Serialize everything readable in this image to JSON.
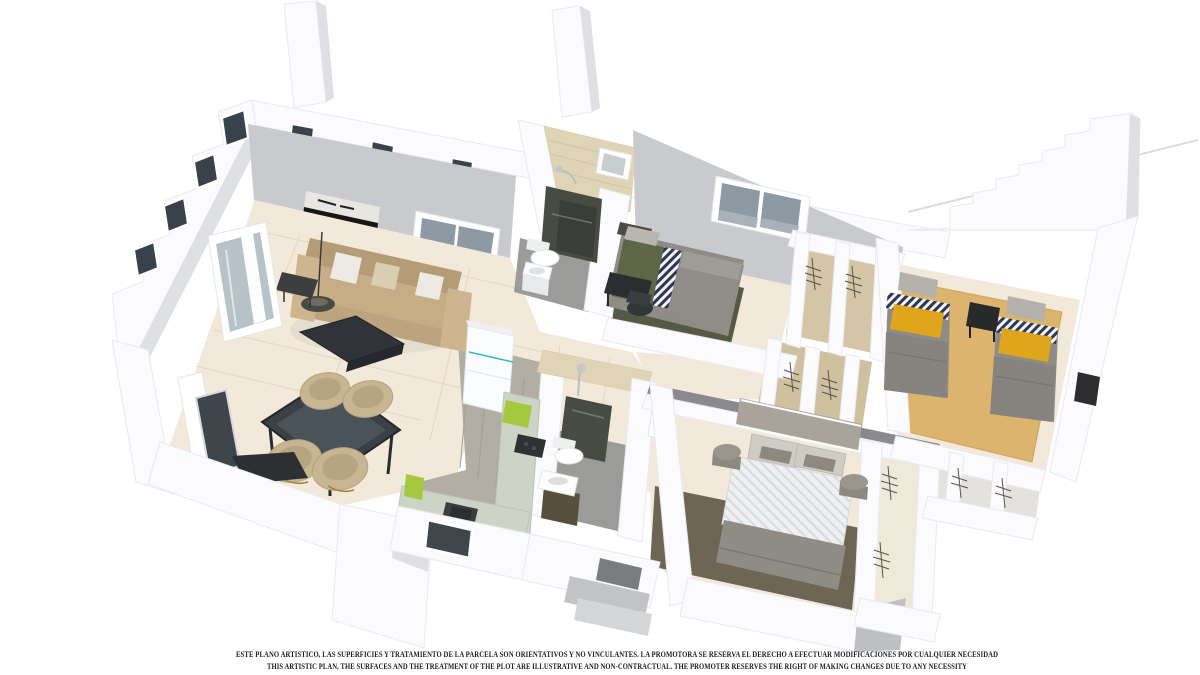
{
  "image_type": "3d-floor-plan-render",
  "disclaimer": {
    "line_es": "ESTE PLANO ARTISTICO, LAS SUPERFICIES Y TRATAMIENTO DE LA PARCELA SON ORIENTATIVOS Y NO VINCULANTES. LA PROMOTORA SE RESERVA EL DERECHO A EFECTUAR MODIFICACIONES POR CUALQUIER NECESIDAD",
    "line_en": "THIS ARTISTIC PLAN, THE SURFACES AND THE TREATMENT OF THE PLOT ARE ILLUSTRATIVE AND NON-CONTRACTUAL. THE PROMOTER RESERVES THE RIGHT OF MAKING CHANGES DUE TO ANY NECESSITY"
  },
  "colors": {
    "background": "#ffffff",
    "exterior_wall": "#fbfbfd",
    "interior_wall_gray": "#c9cacd",
    "bathroom_wall_beige": "#e0d4b6",
    "tile_floor_beige": "#f2e9da",
    "kitchen_wood_gray": "#b2aea4",
    "bathroom_floor_gray": "#9b9b99",
    "shower_panel_dark": "#474b44",
    "twin_carpet_tan": "#dcb46e",
    "rug_olive": "#545a44",
    "rug_master_brown": "#6e6555",
    "sofa_tan": "#c6ad86",
    "mustard_blanket": "#dfa61d",
    "chevron_pillow_navy": "#2e3756",
    "lime_cabinet_accent": "#a4c93e",
    "fridge_accent_teal": "#37b6c9",
    "furniture_black": "#2d3033"
  },
  "rooms": [
    {
      "id": "living-dining",
      "floor": "beige tile",
      "furniture": [
        "tan-sofa",
        "white-cushions",
        "wall-art",
        "floor-lamp",
        "side-table",
        "coffee-table",
        "glass-dining-table",
        "four-tub-chairs",
        "tv-sideboard",
        "sliding-glass-doors"
      ]
    },
    {
      "id": "kitchen",
      "floor": "gray wood planks",
      "furniture": [
        "fridge",
        "counter-run",
        "lime-cabinet",
        "cooktop",
        "sink"
      ]
    },
    {
      "id": "bathroom-1",
      "floor": "gray",
      "furniture": [
        "walk-in-shower",
        "toilet",
        "basin",
        "small-window"
      ]
    },
    {
      "id": "bedroom-1",
      "floor": "beige with olive rug",
      "furniture": [
        "single-bed-olive",
        "chevron-pillow",
        "desk",
        "chair",
        "double-window"
      ]
    },
    {
      "id": "bathroom-2",
      "floor": "gray",
      "furniture": [
        "walk-in-shower",
        "toilet",
        "vanity-basin",
        "door"
      ]
    },
    {
      "id": "wardrobe-closets",
      "floor": "tan",
      "furniture": [
        "open-wardrobes-with-hangers"
      ]
    },
    {
      "id": "twin-bedroom",
      "floor": "tan carpet",
      "furniture": [
        "twin-bed-left",
        "twin-bed-right",
        "mustard-blankets",
        "chevron-pillows",
        "black-nightstand",
        "black-desk"
      ]
    },
    {
      "id": "master-bedroom",
      "floor": "beige with brown rug",
      "furniture": [
        "double-bed-herringbone-duvet",
        "headboard",
        "gray-pillows",
        "round-bedside-tables",
        "walk-in-closets"
      ]
    },
    {
      "id": "stairs",
      "floor": "white steps",
      "furniture": []
    }
  ],
  "exterior": {
    "features": [
      "chimney-left",
      "chimney-center",
      "stepped-west-wall",
      "clerestory-windows",
      "entrance-steps",
      "kitchen-window-opening",
      "roof-line"
    ]
  }
}
